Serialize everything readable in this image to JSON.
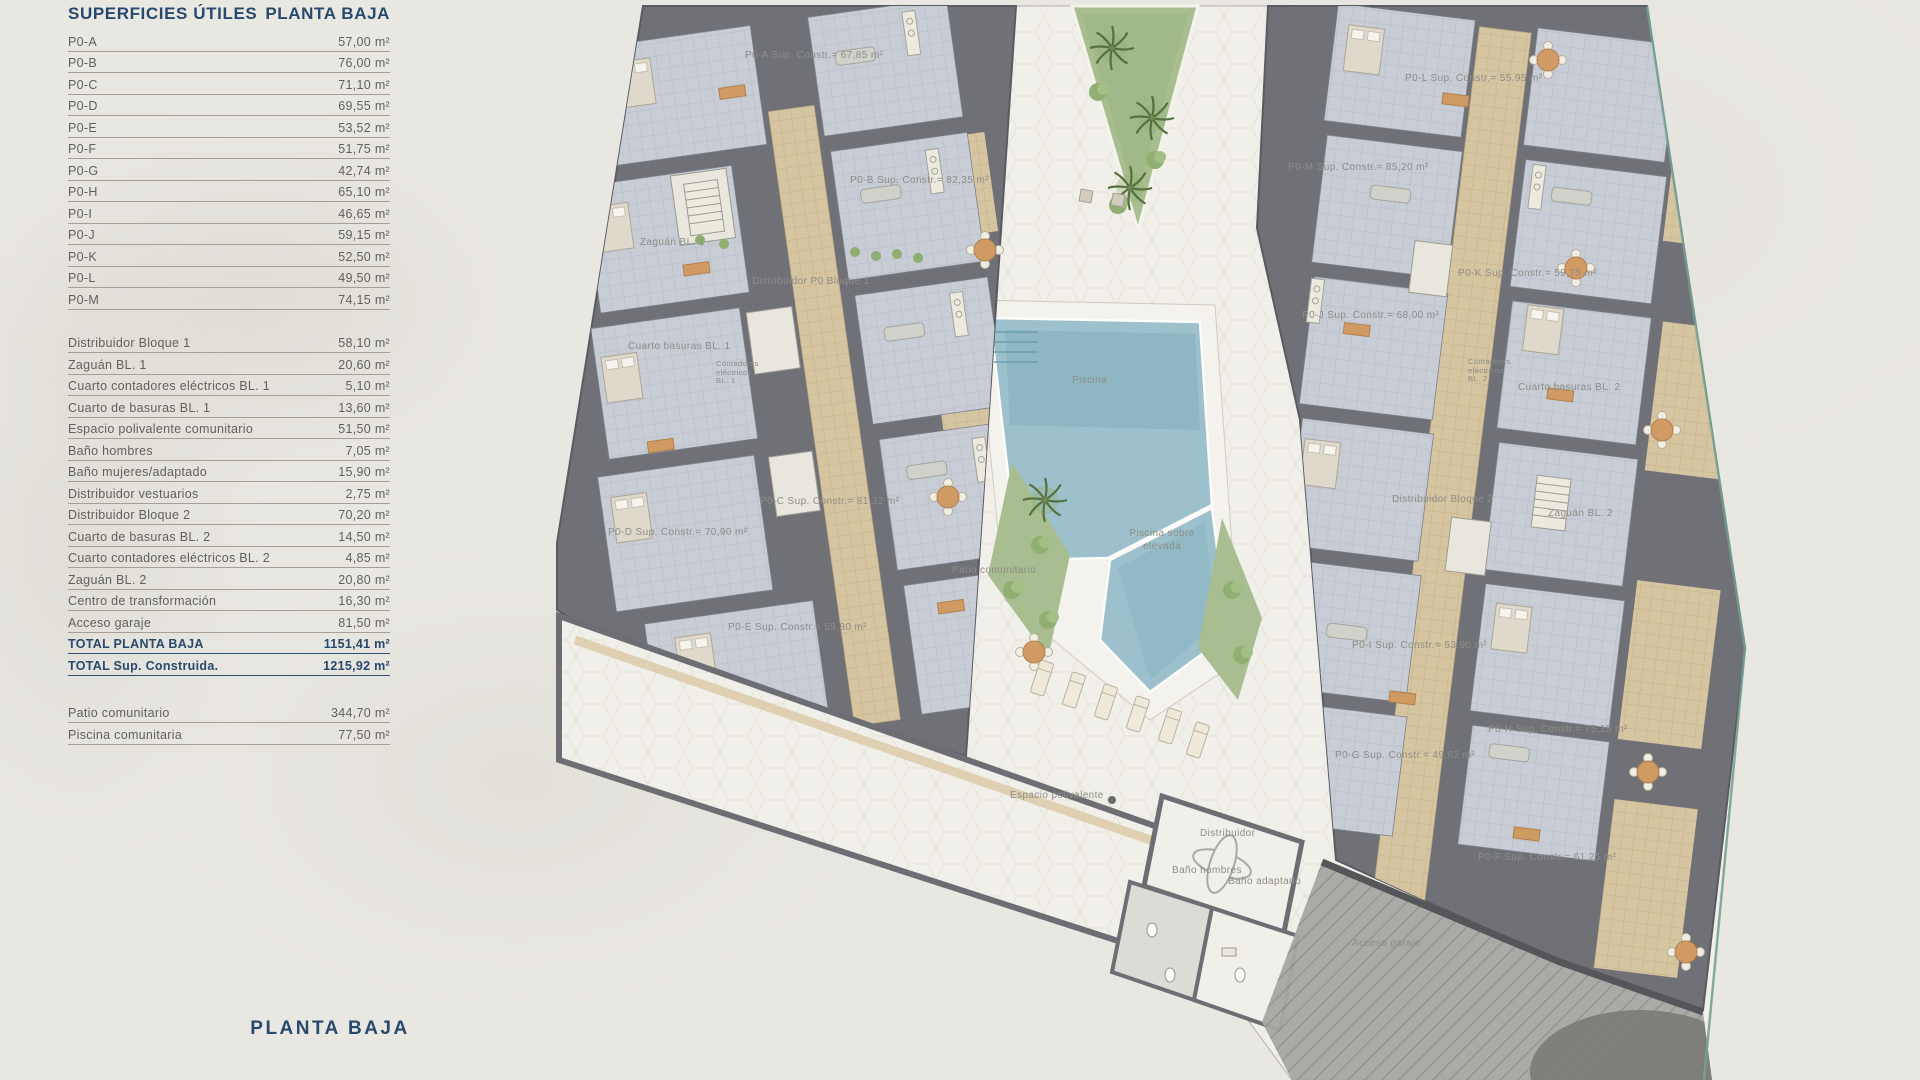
{
  "panel": {
    "title_left": "SUPERFICIES ÚTILES",
    "title_right": "PLANTA BAJA",
    "unit_rows": [
      {
        "label": "P0-A",
        "value": "57,00 m²"
      },
      {
        "label": "P0-B",
        "value": "76,00 m²"
      },
      {
        "label": "P0-C",
        "value": "71,10 m²"
      },
      {
        "label": "P0-D",
        "value": "69,55 m²"
      },
      {
        "label": "P0-E",
        "value": "53,52 m²"
      },
      {
        "label": "P0-F",
        "value": "51,75 m²"
      },
      {
        "label": "P0-G",
        "value": "42,74 m²"
      },
      {
        "label": "P0-H",
        "value": "65,10 m²"
      },
      {
        "label": "P0-I",
        "value": "46,65 m²"
      },
      {
        "label": "P0-J",
        "value": "59,15 m²"
      },
      {
        "label": "P0-K",
        "value": "52,50 m²"
      },
      {
        "label": "P0-L",
        "value": "49,50 m²"
      },
      {
        "label": "P0-M",
        "value": "74,15 m²"
      }
    ],
    "common_rows": [
      {
        "label": "Distribuidor Bloque 1",
        "value": "58,10 m²"
      },
      {
        "label": "Zaguán BL. 1",
        "value": "20,60 m²"
      },
      {
        "label": "Cuarto contadores eléctricos BL. 1",
        "value": "5,10 m²"
      },
      {
        "label": "Cuarto de basuras BL. 1",
        "value": "13,60 m²"
      },
      {
        "label": "Espacio polivalente comunitario",
        "value": "51,50 m²"
      },
      {
        "label": "Baño hombres",
        "value": "7,05 m²"
      },
      {
        "label": "Baño mujeres/adaptado",
        "value": "15,90 m²"
      },
      {
        "label": "Distribuidor vestuarios",
        "value": "2,75 m²"
      },
      {
        "label": "Distribuidor Bloque 2",
        "value": "70,20 m²"
      },
      {
        "label": "Cuarto de basuras BL. 2",
        "value": "14,50 m²"
      },
      {
        "label": "Cuarto contadores eléctricos BL. 2",
        "value": "4,85 m²"
      },
      {
        "label": "Zaguán BL. 2",
        "value": "20,80 m²"
      },
      {
        "label": "Centro de transformación",
        "value": "16,30 m²"
      },
      {
        "label": "Acceso garaje",
        "value": "81,50 m²"
      }
    ],
    "total_rows": [
      {
        "label": "TOTAL PLANTA BAJA",
        "value": "1151,41 m²"
      },
      {
        "label": "TOTAL Sup. Construida.",
        "value": "1215,92 m²"
      }
    ],
    "outdoor_rows": [
      {
        "label": "Patio comunitario",
        "value": "344,70 m²"
      },
      {
        "label": "Piscina comunitaria",
        "value": "77,50 m²"
      }
    ],
    "footer_title": "PLANTA BAJA"
  },
  "plan": {
    "labels": [
      {
        "text": "P0-A Sup. Constr.= 67,85 m²",
        "x": 745,
        "y": 50
      },
      {
        "text": "P0-B Sup. Constr.= 82,35 m²",
        "x": 850,
        "y": 175
      },
      {
        "text": "Zaguán BL. 1",
        "x": 640,
        "y": 237
      },
      {
        "text": "Distribuidor P0 Bloque 1",
        "x": 752,
        "y": 276
      },
      {
        "text": "Cuarto basuras BL. 1",
        "x": 628,
        "y": 341
      },
      {
        "text": "Contadores\neléctricos\nBL. 1",
        "x": 716,
        "y": 360,
        "size": "sm"
      },
      {
        "text": "P0-C Sup. Constr.= 81,32 m²",
        "x": 760,
        "y": 496
      },
      {
        "text": "P0-D Sup. Constr.= 70,90 m²",
        "x": 608,
        "y": 527
      },
      {
        "text": "P0-E Sup. Constr.= 59,80 m²",
        "x": 728,
        "y": 622
      },
      {
        "text": "Piscina",
        "x": 1072,
        "y": 375
      },
      {
        "text": "Piscina sobre\nelevada",
        "x": 1162,
        "y": 528,
        "center": true
      },
      {
        "text": "Patio comunitario",
        "x": 952,
        "y": 565
      },
      {
        "text": "Espacio polivalente",
        "x": 1010,
        "y": 790
      },
      {
        "text": "Distribuidor",
        "x": 1200,
        "y": 828
      },
      {
        "text": "Baño hombres",
        "x": 1172,
        "y": 865
      },
      {
        "text": "Baño adaptado",
        "x": 1228,
        "y": 876
      },
      {
        "text": "Acceso garaje",
        "x": 1352,
        "y": 938
      },
      {
        "text": "P0-L Sup. Constr.= 55,95 m²",
        "x": 1405,
        "y": 73
      },
      {
        "text": "P0-M Sup. Constr.= 85,20 m²",
        "x": 1288,
        "y": 162
      },
      {
        "text": "P0-K Sup. Constr.= 59,75 m²",
        "x": 1458,
        "y": 268
      },
      {
        "text": "P0-J Sup. Constr.= 68,00 m²",
        "x": 1302,
        "y": 310
      },
      {
        "text": "Contadores\neléctricos\nBL. 2",
        "x": 1468,
        "y": 358,
        "size": "sm"
      },
      {
        "text": "Cuarto basuras BL. 2",
        "x": 1518,
        "y": 382
      },
      {
        "text": "Distribuidor Bloque 2",
        "x": 1392,
        "y": 494
      },
      {
        "text": "Zaguán BL. 2",
        "x": 1548,
        "y": 508
      },
      {
        "text": "P0-I Sup. Constr.= 53,90 m²",
        "x": 1352,
        "y": 640
      },
      {
        "text": "P0-G Sup. Constr.= 49,82 m²",
        "x": 1335,
        "y": 750
      },
      {
        "text": "P0-H Sup. Constr.= 75,15 m²",
        "x": 1488,
        "y": 724
      },
      {
        "text": "P0-F Sup. Constr.= 61,25 m²",
        "x": 1478,
        "y": 852
      }
    ],
    "colors": {
      "heading": "#27496d",
      "body_text": "#61605c",
      "plan_text": "#8e8d86",
      "pool": "#9cc1cc",
      "garden": "#a8bd90",
      "walls": "#6f7177",
      "corridor": "#d6c5a1",
      "wood_accent": "#cf9a63",
      "courtyard": "#f1efe9",
      "garage_ramp": "#a6a6a3",
      "property_line": "#74a394"
    }
  }
}
